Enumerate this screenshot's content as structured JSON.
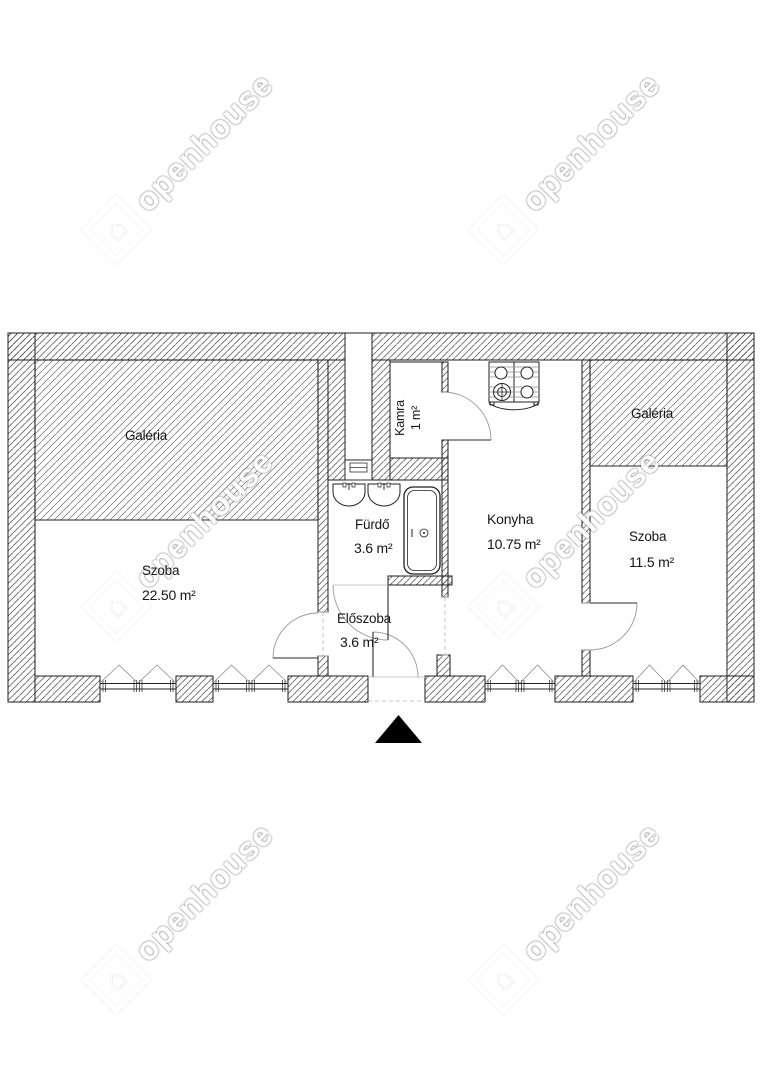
{
  "watermark": {
    "text": "openhouse",
    "logo_icon": "house-in-diamond"
  },
  "rooms": {
    "galeria_left": {
      "name": "Galéria"
    },
    "szoba_left": {
      "name": "Szoba",
      "area": "22.50 m²"
    },
    "kamra": {
      "name": "Kamra",
      "area": "1 m²"
    },
    "furdo": {
      "name": "Fürdő",
      "area": "3.6 m²"
    },
    "konyha": {
      "name": "Konyha",
      "area": "10.75 m²"
    },
    "eloszoba": {
      "name": "Előszoba",
      "area": "3.6 m²"
    },
    "galeria_right": {
      "name": "Galéria"
    },
    "szoba_right": {
      "name": "Szoba",
      "area": "11.5 m²"
    }
  },
  "icons": {
    "entrance_arrow": "filled-triangle-up",
    "fixtures": [
      "stove",
      "sink",
      "sink",
      "bathtub"
    ]
  },
  "colors": {
    "background": "#ffffff",
    "wall_line": "#1c1c1c",
    "hatch": "#4a4a4a",
    "door_arc": "#9a9a9a",
    "entrance_arrow": "#000000",
    "watermark": "#ffffff"
  }
}
